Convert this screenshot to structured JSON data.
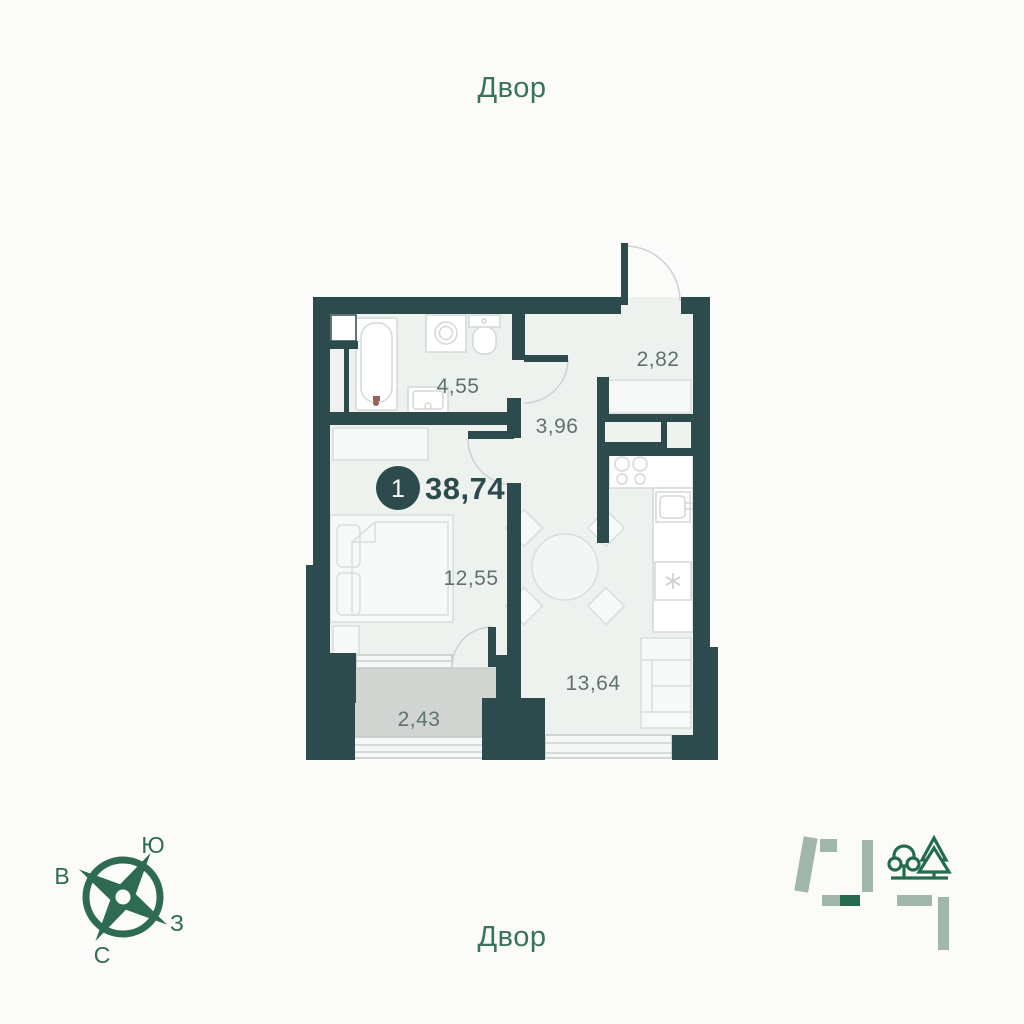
{
  "courtyard": {
    "top": "Двор",
    "bottom": "Двор"
  },
  "apartment": {
    "badge_rooms": "1",
    "total_area": "38,74",
    "rooms": {
      "bathroom": {
        "area": "4,55"
      },
      "entry": {
        "area": "2,82"
      },
      "hall": {
        "area": "3,96"
      },
      "bedroom": {
        "area": "12,55"
      },
      "kitchen_living": {
        "area": "13,64"
      },
      "balcony": {
        "area": "2,43"
      }
    }
  },
  "compass": {
    "south": "Ю",
    "east": "В",
    "west": "З",
    "north": "С"
  },
  "icons": {
    "compass": "compass-rose-icon",
    "site_plan": "site-plan-icon",
    "park": "park-trees-icon"
  },
  "colors": {
    "wall": "#2d4a4c",
    "floor": "#edf2ef",
    "balcony": "#d2d4d2",
    "green": "#2e6b52",
    "sage": "#a2b7ab",
    "label": "#5f7170"
  }
}
